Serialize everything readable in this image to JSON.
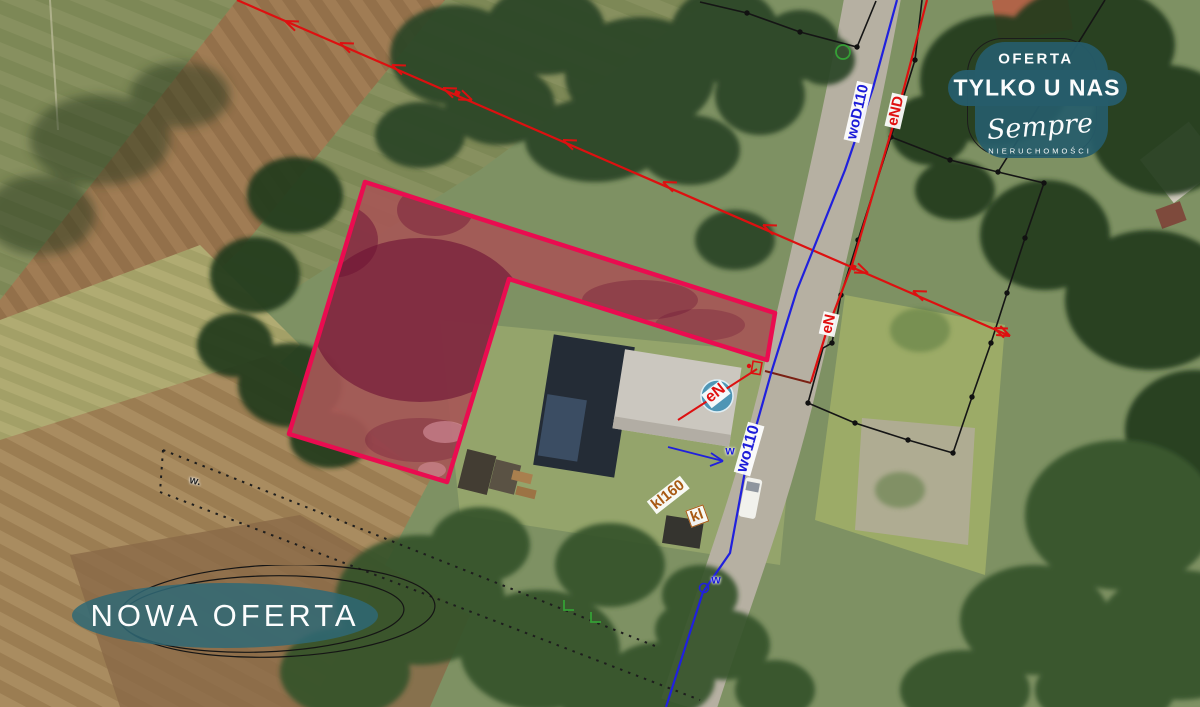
{
  "annotations": {
    "water_supply_top": "woD110",
    "power_line_top": "eND",
    "power_line_road": "eN",
    "power_line_yard": "eN",
    "water_supply_bottom": "wo110",
    "water_connection": "w",
    "water_point": "w",
    "boundary_note": "w.",
    "sewer_line": "kl160",
    "sewer_line_short": "kl"
  },
  "badge_new_offer": {
    "label": "NOWA OFERTA"
  },
  "badge_exclusive": {
    "line1": "OFERTA",
    "line2": "TYLKO U NAS",
    "brand": "Sempre",
    "brand_subtitle": "NIERUCHOMOŚCI"
  },
  "colors": {
    "parcel_outline": "#ea0c50",
    "water_line": "#2020dd",
    "power_line": "#dd1010",
    "sewer_label": "#a85a14",
    "badge_teal": "#2b5f6e"
  }
}
